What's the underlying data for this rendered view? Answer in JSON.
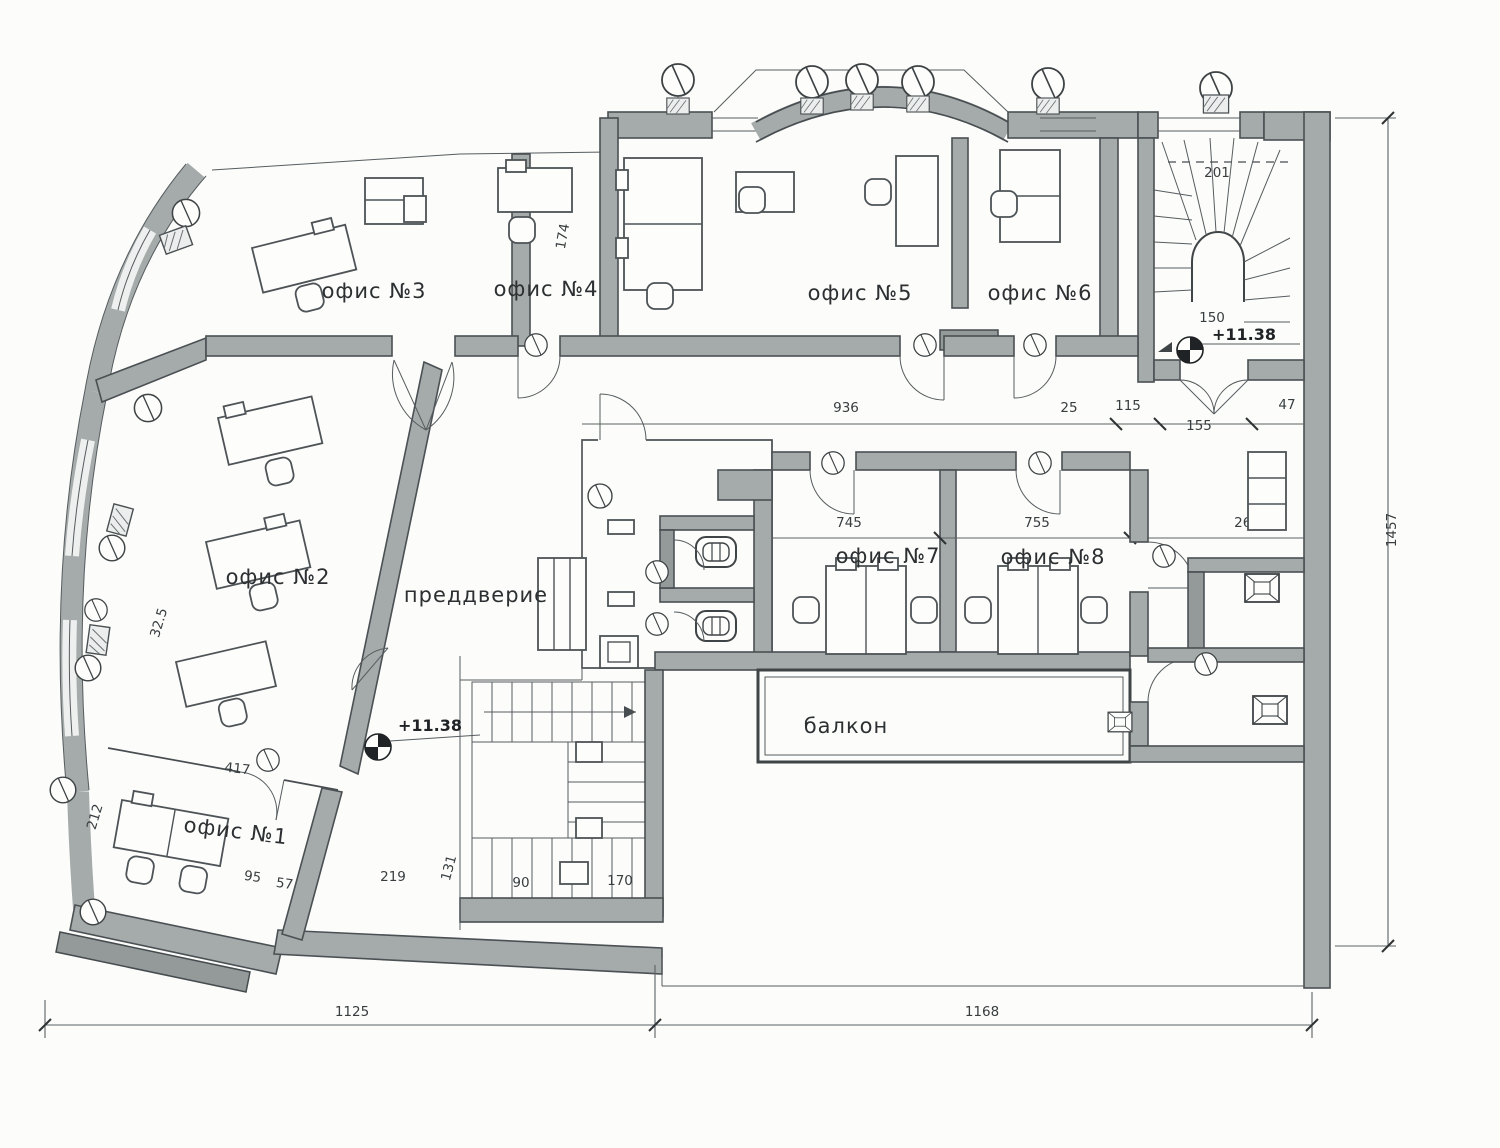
{
  "meta": {
    "kind": "architectural-floor-plan",
    "language": "ru"
  },
  "rooms": {
    "office1": "офис №1",
    "office2": "офис №2",
    "office3": "офис №3",
    "office4": "офис №4",
    "office5": "офис №5",
    "office6": "офис №6",
    "office7": "офис №7",
    "office8": "офис №8",
    "vestibule": "преддверие",
    "balcony": "балкон"
  },
  "elevations": {
    "hall_bottom": "+11.38",
    "stair_top": "+11.38"
  },
  "dims": {
    "bottom_left": "1125",
    "bottom_right": "1168",
    "right_vertical": "1457",
    "corridor": "936",
    "d25": "25",
    "d115": "115",
    "d155": "155",
    "d47": "47",
    "d745": "745",
    "d755": "755",
    "d262": "262",
    "d201": "201",
    "d150": "150",
    "d417": "417",
    "d212": "212",
    "d95": "95",
    "d57": "57",
    "d32_5": "32.5",
    "d174": "174",
    "d219": "219",
    "d131": "131",
    "d90": "90",
    "d170": "170"
  },
  "colors": {
    "wall": "#a5abaa",
    "line": "#474d50",
    "paper": "#fcfcfa"
  }
}
